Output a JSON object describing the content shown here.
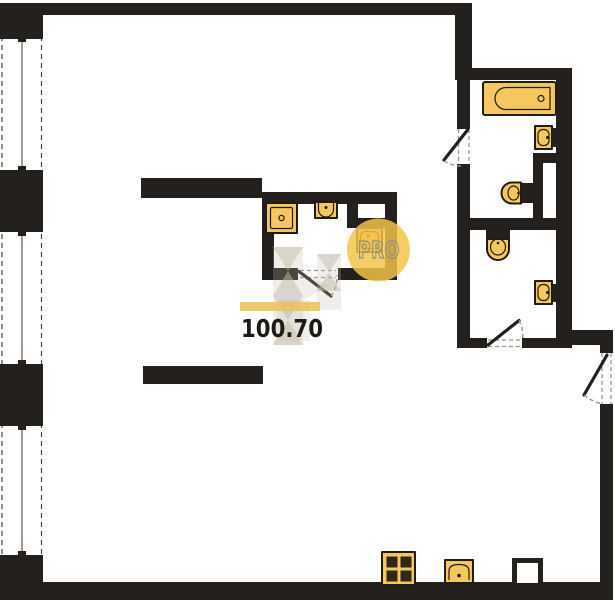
{
  "plan": {
    "area_label": "100.70",
    "watermark": {
      "text": "PRO"
    }
  },
  "fixtures": [
    "bathtub",
    "wall-sink-bathroom",
    "toilet-bathroom",
    "toilet-wc",
    "wall-sink-wc",
    "shower-tray",
    "top-sink-ensuite",
    "wall-sink-ensuite",
    "stove-4-burner",
    "kitchen-sink",
    "duct-shaft"
  ],
  "colors": {
    "wall": "#23201d",
    "fixture-fill": "#f6c75f",
    "fixture-stroke": "#201b14",
    "door-arc": "#9a958d",
    "window-line": "#4a4741",
    "watermark-yellow": "#f3c34a",
    "watermark-gray": "#c4bbaa",
    "highlight-bar": "#ecc25d",
    "label-text": "#1c1b18",
    "watermark-text": "#8f8c82",
    "burner": "#302718"
  }
}
